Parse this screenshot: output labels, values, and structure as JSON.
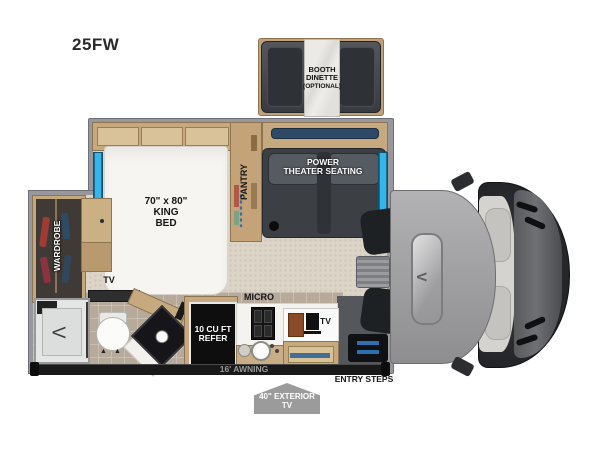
{
  "model_label": "25FW",
  "colors": {
    "accent": "#35b5e8",
    "wall": "#98989c",
    "wood": "#c6a97f",
    "floor_main": "#dcd5c7",
    "floor_tile": "#b8aa9b",
    "seat_dark": "#3c4044",
    "refer_black": "#0e0e0e",
    "awning_bar": "#191919",
    "badge_gray": "#9b9b9b",
    "cab_gray": "#a3a3a5",
    "cab_dark": "#232528"
  },
  "dinette": {
    "l1": "BOOTH",
    "l2": "DINETTE",
    "l3": "(OPTIONAL)"
  },
  "bedroom": {
    "bed_l1": "70\" x 80\"",
    "bed_l2": "KING",
    "bed_l3": "BED",
    "pantry": "PANTRY",
    "wardrobe": "WARDROBE",
    "tv": "TV"
  },
  "living": {
    "theater_l1": "POWER",
    "theater_l2": "THEATER SEATING"
  },
  "kitchen": {
    "micro": "MICRO",
    "refer_l1": "10 CU FT",
    "refer_l2": "REFER",
    "tv": "TV"
  },
  "exterior": {
    "awning": "16' AWNING",
    "entry_steps": "ENTRY STEPS",
    "ext_tv_l1": "40\" EXTERIOR",
    "ext_tv_l2": "TV"
  }
}
